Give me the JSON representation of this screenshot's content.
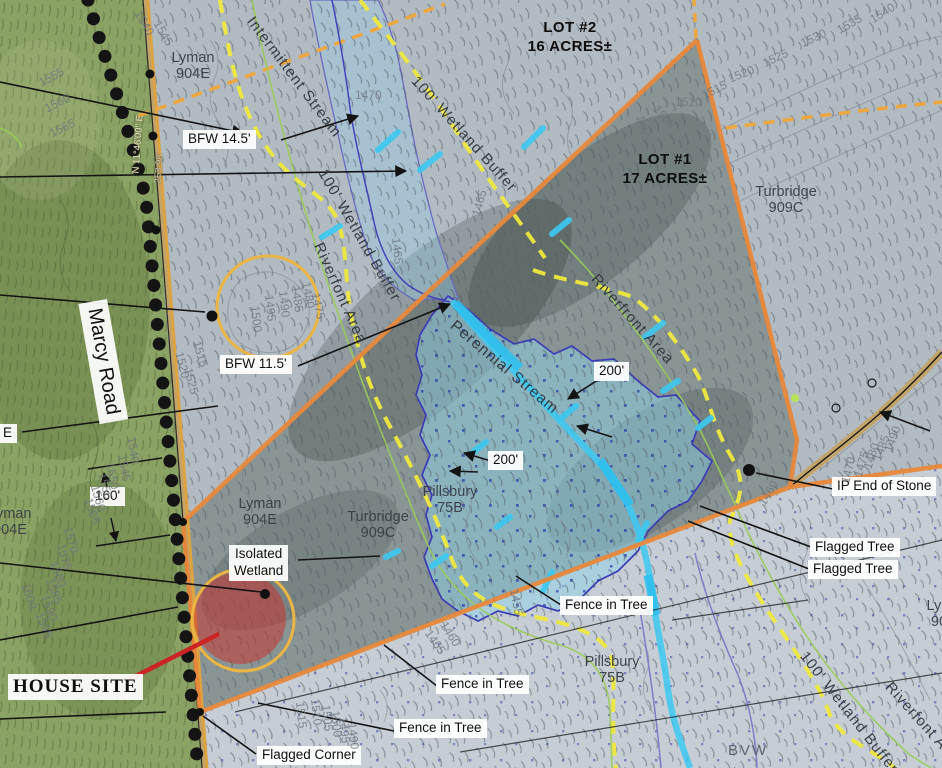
{
  "map_labels": {
    "lot1_title": "LOT #1",
    "lot1_area": "17 ACRES±",
    "lot2_title": "LOT #2",
    "lot2_area": "16 ACRES±",
    "marcy_road": "Marcy Road",
    "house_site": "HOUSE SITE",
    "isolated_wetland_line1": "Isolated",
    "isolated_wetland_line2": "Wetland",
    "flagged_corner": "Flagged Corner",
    "fence_in_tree": "Fence in Tree",
    "flagged_tree": "Flagged Tree",
    "ip_end_of_stone": "IP End of Stone",
    "bfw_14_5": "BFW 14.5'",
    "bfw_11_5": "BFW 11.5'",
    "dim_160": "160'",
    "dim_200": "200'",
    "bvw": "BVW",
    "edge_e": "E",
    "perennial_stream": "Perennial Stream",
    "intermittent_stream": "Intermittent Stream",
    "wetland_buffer_100": "100' Wetland Buffer",
    "riverfront_area": "Riverfront Area",
    "riverfont_area": "Riverfont Area",
    "bearing_marcy": "N 11°46'00\" E",
    "distance_marcy": "253.98'"
  },
  "soil_units": {
    "lyman_name": "Lyman",
    "lyman_code": "904E",
    "turbridge_name": "Turbridge",
    "turbridge_code": "909C",
    "pillsbury_name": "Pillsbury",
    "pillsbury_code": "75B"
  },
  "contours": [
    {
      "t": "1540"
    },
    {
      "t": "1545"
    },
    {
      "t": "1555"
    },
    {
      "t": "1560"
    },
    {
      "t": "1565"
    },
    {
      "t": "1500"
    },
    {
      "t": "1495"
    },
    {
      "t": "1490"
    },
    {
      "t": "1485"
    },
    {
      "t": "1480"
    },
    {
      "t": "1475"
    },
    {
      "t": "1470"
    },
    {
      "t": "1465"
    },
    {
      "t": "1465"
    },
    {
      "t": "1495"
    },
    {
      "t": "1505"
    },
    {
      "t": "1510"
    },
    {
      "t": "1515"
    },
    {
      "t": "1520"
    },
    {
      "t": "1525"
    },
    {
      "t": "1530"
    },
    {
      "t": "1535"
    },
    {
      "t": "1540"
    },
    {
      "t": "1470"
    },
    {
      "t": "1475"
    },
    {
      "t": "1480"
    },
    {
      "t": "1485"
    },
    {
      "t": "1490"
    },
    {
      "t": "1520"
    },
    {
      "t": "1525"
    },
    {
      "t": "1515"
    },
    {
      "t": "1540"
    },
    {
      "t": "1545"
    },
    {
      "t": "1550"
    },
    {
      "t": "1555"
    },
    {
      "t": "1560"
    },
    {
      "t": "1565"
    },
    {
      "t": "1570"
    },
    {
      "t": "1575"
    },
    {
      "t": "1580"
    },
    {
      "t": "1585"
    },
    {
      "t": "1590"
    },
    {
      "t": "1595"
    },
    {
      "t": "1600"
    },
    {
      "t": "1465"
    },
    {
      "t": "1460"
    },
    {
      "t": "1455"
    },
    {
      "t": "1515"
    },
    {
      "t": "1510"
    },
    {
      "t": "1505"
    },
    {
      "t": "1500"
    },
    {
      "t": "1495"
    },
    {
      "t": "1490"
    },
    {
      "t": "1460"
    },
    {
      "t": "1475"
    }
  ],
  "legend_colors": {
    "boundary_orange": "#e8883b",
    "wetland_buffer_yellow": "#efe93e",
    "stream_cyan": "#3cc9f2",
    "wetland_blue": "#8ed2e8",
    "house_site_red": "#cc2424",
    "highlight_circle_orange": "#eab543"
  }
}
